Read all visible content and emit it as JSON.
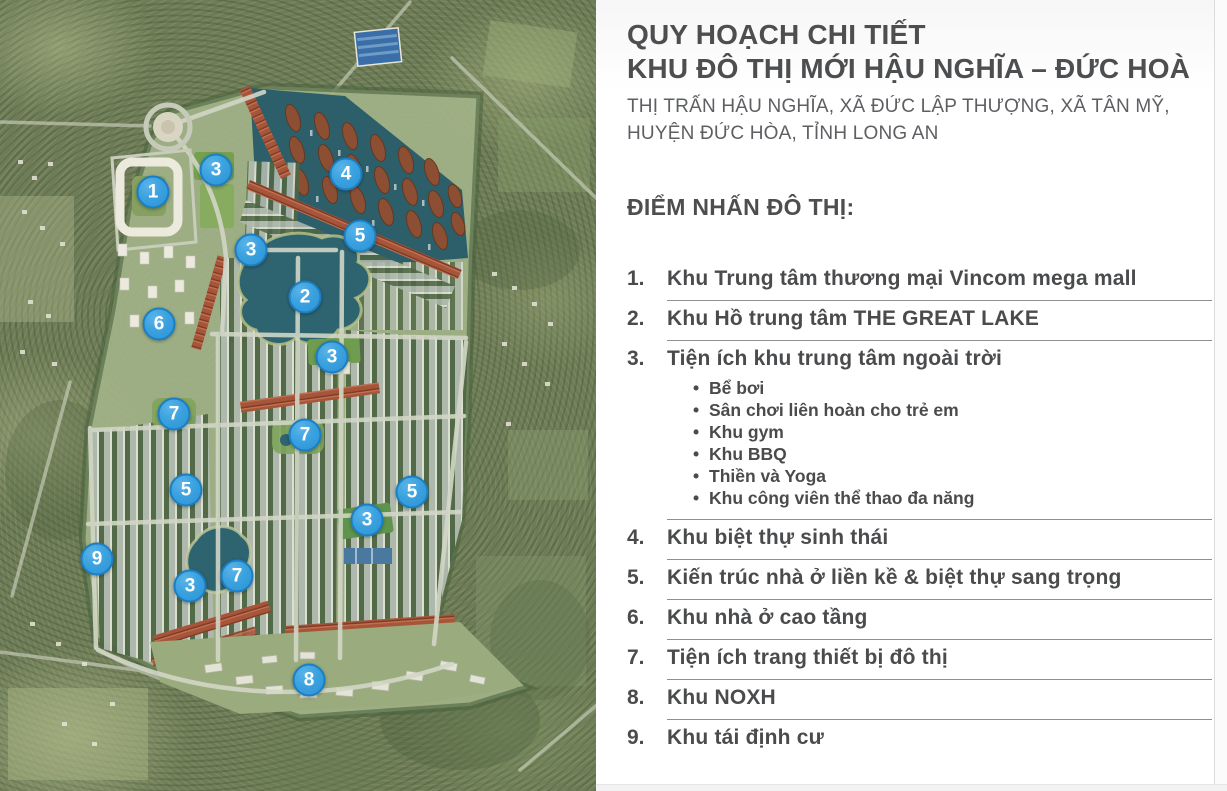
{
  "panel": {
    "title_line1": "QUY HOẠCH CHI TIẾT",
    "title_line2": "KHU ĐÔ THỊ MỚI HẬU NGHĨA – ĐỨC HOÀ",
    "subtitle_line1": "THỊ TRẤN HẬU NGHĨA, XÃ ĐỨC LẬP THƯỢNG, XÃ TÂN MỸ,",
    "subtitle_line2": "HUYỆN ĐỨC HÒA, TỈNH LONG AN",
    "section_heading": "ĐIỂM NHẤN ĐÔ THỊ:",
    "items": [
      {
        "num": "1.",
        "label": "Khu Trung tâm thương mại Vincom mega mall"
      },
      {
        "num": "2.",
        "label": "Khu Hồ trung tâm THE GREAT LAKE"
      },
      {
        "num": "3.",
        "label": "Tiện ích khu trung tâm ngoài trời",
        "sub": [
          "Bể bơi",
          "Sân chơi liên hoàn cho trẻ em",
          "Khu gym",
          "Khu BBQ",
          "Thiền và Yoga",
          "Khu công viên thể thao đa năng"
        ]
      },
      {
        "num": "4.",
        "label": "Khu biệt thự sinh thái"
      },
      {
        "num": "5.",
        "label": "Kiến trúc nhà ở liền kề & biệt thự sang trọng"
      },
      {
        "num": "6.",
        "label": "Khu nhà ở cao tầng"
      },
      {
        "num": "7.",
        "label": "Tiện ích trang thiết bị đô thị"
      },
      {
        "num": "8.",
        "label": "Khu NOXH"
      },
      {
        "num": "9.",
        "label": "Khu tái định cư"
      }
    ],
    "bullet_char": "•"
  },
  "map": {
    "description": "aerial-master-plan",
    "markers": [
      {
        "label": "1",
        "x": 153,
        "y": 192
      },
      {
        "label": "3",
        "x": 216,
        "y": 170
      },
      {
        "label": "4",
        "x": 346,
        "y": 174
      },
      {
        "label": "5",
        "x": 360,
        "y": 236
      },
      {
        "label": "3",
        "x": 251,
        "y": 250
      },
      {
        "label": "2",
        "x": 305,
        "y": 297
      },
      {
        "label": "6",
        "x": 159,
        "y": 324
      },
      {
        "label": "3",
        "x": 332,
        "y": 357
      },
      {
        "label": "7",
        "x": 174,
        "y": 414
      },
      {
        "label": "7",
        "x": 305,
        "y": 435
      },
      {
        "label": "5",
        "x": 186,
        "y": 490
      },
      {
        "label": "5",
        "x": 412,
        "y": 492
      },
      {
        "label": "3",
        "x": 367,
        "y": 520
      },
      {
        "label": "9",
        "x": 97,
        "y": 559
      },
      {
        "label": "7",
        "x": 237,
        "y": 576
      },
      {
        "label": "3",
        "x": 190,
        "y": 586
      },
      {
        "label": "8",
        "x": 309,
        "y": 680
      }
    ],
    "colors": {
      "marker_fill": "#3ba2e0",
      "marker_border": "#1b7ec2",
      "marker_text": "#ffffff",
      "water": "#2d5f6b",
      "red_roof": "#a7553a",
      "plan_green": "#a3b388",
      "forest_green": "#6e7d57",
      "road": "#d2d7c6"
    }
  }
}
